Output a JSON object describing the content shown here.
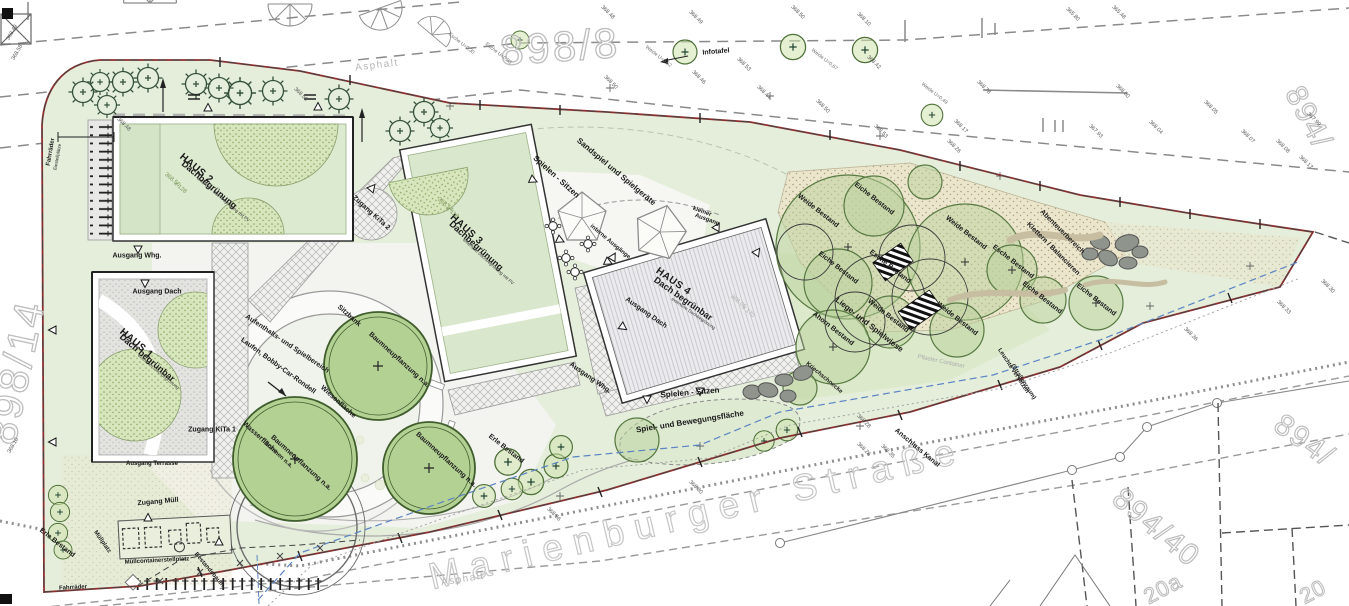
{
  "colors": {
    "site_green": "#e4eeda",
    "boundary_red": "#8c2f2f",
    "roof_green": "#d9e7cc",
    "roof_gray": "#e3e3e1",
    "sand": "#ebe5cc",
    "water_blue": "#5b84c4",
    "tree_green": "#b9d29c"
  },
  "labels": [
    {
      "t": "898/8",
      "x": 560,
      "y": 47,
      "r": -4,
      "k": "p",
      "n": "parcel-898-8"
    },
    {
      "t": "898/14",
      "x": 16,
      "y": 372,
      "r": -78,
      "k": "p",
      "n": "parcel-898-14"
    },
    {
      "t": "894/",
      "x": 1308,
      "y": 118,
      "r": 62,
      "k": "p2",
      "n": "parcel-894"
    },
    {
      "t": "894/",
      "x": 1304,
      "y": 441,
      "r": 36,
      "k": "p2",
      "n": "parcel-894b"
    },
    {
      "t": "894/40",
      "x": 1156,
      "y": 528,
      "r": 40,
      "k": "p2",
      "n": "parcel-894-40"
    },
    {
      "t": "20a",
      "x": 1163,
      "y": 589,
      "r": -28,
      "k": "p3",
      "n": "housenumber-20a"
    },
    {
      "t": "20",
      "x": 1313,
      "y": 592,
      "r": -28,
      "k": "p3",
      "n": "housenumber-20"
    },
    {
      "t": "Marienburger Straße",
      "x": 697,
      "y": 513,
      "r": -13.5,
      "k": "st",
      "n": "street-name"
    },
    {
      "t": "Asphalt",
      "x": 377,
      "y": 66,
      "r": -7,
      "k": "g",
      "n": "surface-asphalt-top"
    },
    {
      "t": "Asphalt",
      "x": 463,
      "y": 580,
      "r": -9,
      "k": "g",
      "n": "surface-asphalt-bottom"
    },
    {
      "t": "HAUS 2",
      "x": 196,
      "y": 169,
      "r": 40,
      "k": "h1",
      "n": "haus-2-title"
    },
    {
      "t": "Dachbegrünung",
      "x": 209,
      "y": 185,
      "r": 40,
      "k": "h2"
    },
    {
      "t": "extensive Dachbegrünung mit PV",
      "x": 223,
      "y": 200,
      "r": 40,
      "k": "h3"
    },
    {
      "t": "HAUS 1",
      "x": 136,
      "y": 344,
      "r": 40,
      "k": "h1",
      "n": "haus-1-title"
    },
    {
      "t": "Dach begrünbar",
      "x": 147,
      "y": 358,
      "r": 40,
      "k": "h2"
    },
    {
      "t": "extensive Dachbegrünung",
      "x": 158,
      "y": 372,
      "r": 40,
      "k": "h3"
    },
    {
      "t": "HAUS 3",
      "x": 466,
      "y": 230,
      "r": 42,
      "k": "h1",
      "n": "haus-3-title"
    },
    {
      "t": "Dachbegrünung",
      "x": 476,
      "y": 246,
      "r": 42,
      "k": "h2"
    },
    {
      "t": "extensive Dachbegrünung mit PV",
      "x": 488,
      "y": 262,
      "r": 42,
      "k": "h3"
    },
    {
      "t": "HAUS 4",
      "x": 673,
      "y": 282,
      "r": 35,
      "k": "h1",
      "n": "haus-4-title"
    },
    {
      "t": "Dach begrünbar",
      "x": 683,
      "y": 299,
      "r": 35,
      "k": "h2"
    },
    {
      "t": "extensive Dachbegrünung",
      "x": 693,
      "y": 314,
      "r": 35,
      "k": "h3"
    },
    {
      "t": "Ausgang Whg.",
      "x": 137,
      "y": 256,
      "r": 0,
      "k": "s"
    },
    {
      "t": "Ausgang Dach",
      "x": 157,
      "y": 292,
      "r": 0,
      "k": "s"
    },
    {
      "t": "Ausgang Dach",
      "x": 646,
      "y": 313,
      "r": 35,
      "k": "s"
    },
    {
      "t": "Ausgang Whg.",
      "x": 590,
      "y": 378,
      "r": 35,
      "k": "s"
    },
    {
      "t": "Zugang KiTa 1",
      "x": 212,
      "y": 430,
      "r": 0,
      "k": "s"
    },
    {
      "t": "Zugang KiTa 2",
      "x": 371,
      "y": 213,
      "r": 42,
      "k": "s"
    },
    {
      "t": "Ausgang Terrasse",
      "x": 152,
      "y": 464,
      "r": 0,
      "k": "s2"
    },
    {
      "t": "Zugang Müll",
      "x": 158,
      "y": 502,
      "r": -5,
      "k": "s"
    },
    {
      "t": "Müllcontainerstellplatz",
      "x": 157,
      "y": 561,
      "r": -3,
      "k": "s2"
    },
    {
      "t": "Müllplatz",
      "x": 102,
      "y": 542,
      "r": 55,
      "k": "s2"
    },
    {
      "t": "Fahrräder",
      "x": 73,
      "y": 588,
      "r": -3,
      "k": "s2"
    },
    {
      "t": "Fahrräder",
      "x": 51,
      "y": 152,
      "r": -80,
      "k": "s2"
    },
    {
      "t": "Einstellplätze",
      "x": 58,
      "y": 157,
      "r": -80,
      "k": "s3"
    },
    {
      "t": "Sitzbank",
      "x": 349,
      "y": 316,
      "r": 42,
      "k": "s"
    },
    {
      "t": "Wiesenfläche",
      "x": 338,
      "y": 402,
      "r": 42,
      "k": "s"
    },
    {
      "t": "Wasserfläche",
      "x": 260,
      "y": 438,
      "r": 42,
      "k": "s"
    },
    {
      "t": "Brunnen n.a.",
      "x": 278,
      "y": 455,
      "r": 42,
      "k": "s2"
    },
    {
      "t": "Baumneupflanzung n.a.",
      "x": 399,
      "y": 360,
      "r": 42,
      "k": "s"
    },
    {
      "t": "Baumneupflanzung n.a.",
      "x": 301,
      "y": 463,
      "r": 42,
      "k": "s"
    },
    {
      "t": "Baumneupflanzung n.a.",
      "x": 446,
      "y": 460,
      "r": 42,
      "k": "s"
    },
    {
      "t": "Aufenthalts- und Spielbereich",
      "x": 287,
      "y": 344,
      "r": 34,
      "k": "s"
    },
    {
      "t": "Laufen, Bobby-Car-Rondell",
      "x": 278,
      "y": 366,
      "r": 36,
      "k": "s"
    },
    {
      "t": "Sandspiel und Spielgeräte",
      "x": 616,
      "y": 172,
      "r": 40,
      "k": "l"
    },
    {
      "t": "Spielen - Sitzen",
      "x": 556,
      "y": 177,
      "r": 42,
      "k": "l"
    },
    {
      "t": "Spielen - Sitzen",
      "x": 690,
      "y": 393,
      "r": -5,
      "k": "l"
    },
    {
      "t": "Spiel- und Bewegungsfläche",
      "x": 690,
      "y": 422,
      "r": -9,
      "k": "l"
    },
    {
      "t": "interne Ausgänge",
      "x": 610,
      "y": 242,
      "r": 40,
      "k": "s2"
    },
    {
      "t": "kleiner",
      "x": 702,
      "y": 212,
      "r": 20,
      "k": "s2"
    },
    {
      "t": "Ausgang",
      "x": 707,
      "y": 220,
      "r": 20,
      "k": "s2"
    },
    {
      "t": "Infotafel",
      "x": 716,
      "y": 52,
      "r": -5,
      "k": "s"
    },
    {
      "t": "Liege- und Spielwiese",
      "x": 869,
      "y": 325,
      "r": 38,
      "k": "l"
    },
    {
      "t": "Ahorn Bestand",
      "x": 833,
      "y": 329,
      "r": 38,
      "k": "s"
    },
    {
      "t": "Weide Bestand",
      "x": 818,
      "y": 211,
      "r": 38,
      "k": "s"
    },
    {
      "t": "Weide Bestand",
      "x": 966,
      "y": 233,
      "r": 38,
      "k": "s"
    },
    {
      "t": "Weide Bestand",
      "x": 888,
      "y": 316,
      "r": 38,
      "k": "s"
    },
    {
      "t": "Weide Bestand",
      "x": 957,
      "y": 319,
      "r": 38,
      "k": "s"
    },
    {
      "t": "Esche Bestand",
      "x": 890,
      "y": 267,
      "r": 38,
      "k": "s"
    },
    {
      "t": "Esche Bestand",
      "x": 1013,
      "y": 262,
      "r": 38,
      "k": "s"
    },
    {
      "t": "Eiche Bestand",
      "x": 874,
      "y": 199,
      "r": 38,
      "k": "s"
    },
    {
      "t": "Eiche Bestand",
      "x": 838,
      "y": 268,
      "r": 38,
      "k": "s"
    },
    {
      "t": "Eiche Bestand",
      "x": 1096,
      "y": 300,
      "r": 38,
      "k": "s"
    },
    {
      "t": "Eiche Bestand",
      "x": 1042,
      "y": 298,
      "r": 38,
      "k": "s"
    },
    {
      "t": "Erle Bestand",
      "x": 506,
      "y": 449,
      "r": 38,
      "k": "s"
    },
    {
      "t": "Erle Bestand",
      "x": 57,
      "y": 543,
      "r": 38,
      "k": "s"
    },
    {
      "t": "Abenteuerbereich",
      "x": 1062,
      "y": 232,
      "r": 45,
      "k": "s"
    },
    {
      "t": "Klettern / Balancieren",
      "x": 1053,
      "y": 249,
      "r": 45,
      "k": "s"
    },
    {
      "t": "Anschluss Kanal",
      "x": 917,
      "y": 448,
      "r": 40,
      "k": "s"
    },
    {
      "t": "Leuchte versetzen",
      "x": 1013,
      "y": 371,
      "r": 57,
      "k": "s2"
    },
    {
      "t": "(Straßenraum)",
      "x": 1023,
      "y": 382,
      "r": 57,
      "k": "s2"
    },
    {
      "t": "Kriechschnecke",
      "x": 824,
      "y": 378,
      "r": 40,
      "k": "s2"
    },
    {
      "t": "Pflaster Container",
      "x": 941,
      "y": 362,
      "r": 12,
      "k": "g2"
    },
    {
      "t": "Bestandsbaum",
      "x": 209,
      "y": 570,
      "r": 50,
      "k": "s2"
    },
    {
      "t": "Esche U=0,30",
      "x": 461,
      "y": 44,
      "r": 38,
      "k": "tg"
    },
    {
      "t": "Esche U=0,33",
      "x": 498,
      "y": 54,
      "r": 38,
      "k": "tg"
    },
    {
      "t": "Weide U=0,52",
      "x": 658,
      "y": 57,
      "r": 38,
      "k": "tg"
    },
    {
      "t": "Weide U=0,67",
      "x": 824,
      "y": 60,
      "r": 38,
      "k": "tg"
    },
    {
      "t": "Weide U=0,49",
      "x": 934,
      "y": 94,
      "r": 38,
      "k": "tg"
    },
    {
      "t": "368.48",
      "x": 607,
      "y": 13,
      "r": 45,
      "k": "e"
    },
    {
      "t": "368.49",
      "x": 695,
      "y": 18,
      "r": 45,
      "k": "e"
    },
    {
      "t": "368.50",
      "x": 797,
      "y": 13,
      "r": 45,
      "k": "e"
    },
    {
      "t": "368.10",
      "x": 863,
      "y": 20,
      "r": 45,
      "k": "e"
    },
    {
      "t": "368.50",
      "x": 610,
      "y": 83,
      "r": 45,
      "k": "e"
    },
    {
      "t": "368.53",
      "x": 743,
      "y": 65,
      "r": 45,
      "k": "e"
    },
    {
      "t": "368.46",
      "x": 698,
      "y": 78,
      "r": 45,
      "k": "e"
    },
    {
      "t": "368.44",
      "x": 763,
      "y": 93,
      "r": 45,
      "k": "e"
    },
    {
      "t": "368.50",
      "x": 822,
      "y": 107,
      "r": 45,
      "k": "e"
    },
    {
      "t": "368.53",
      "x": 880,
      "y": 132,
      "r": 45,
      "k": "e"
    },
    {
      "t": "368.42",
      "x": 873,
      "y": 63,
      "r": 45,
      "k": "e"
    },
    {
      "t": "365.80",
      "x": 1072,
      "y": 15,
      "r": 45,
      "k": "e"
    },
    {
      "t": "365.48",
      "x": 1118,
      "y": 13,
      "r": 45,
      "k": "e"
    },
    {
      "t": "368.78",
      "x": 983,
      "y": 88,
      "r": 45,
      "k": "e"
    },
    {
      "t": "368.80",
      "x": 1122,
      "y": 92,
      "r": 45,
      "k": "e"
    },
    {
      "t": "368.05",
      "x": 1210,
      "y": 108,
      "r": 45,
      "k": "e"
    },
    {
      "t": "367.99",
      "x": 1313,
      "y": 120,
      "r": 45,
      "k": "e"
    },
    {
      "t": "368.17",
      "x": 960,
      "y": 127,
      "r": 45,
      "k": "e"
    },
    {
      "t": "367.93",
      "x": 1095,
      "y": 132,
      "r": 45,
      "k": "e"
    },
    {
      "t": "368.04",
      "x": 1155,
      "y": 128,
      "r": 45,
      "k": "e"
    },
    {
      "t": "368.07",
      "x": 1247,
      "y": 137,
      "r": 45,
      "k": "e"
    },
    {
      "t": "368.08",
      "x": 1282,
      "y": 147,
      "r": 45,
      "k": "e"
    },
    {
      "t": "368.17",
      "x": 1305,
      "y": 163,
      "r": 45,
      "k": "e"
    },
    {
      "t": "368.26",
      "x": 953,
      "y": 147,
      "r": 45,
      "k": "e"
    },
    {
      "t": "368.26",
      "x": 863,
      "y": 450,
      "r": 45,
      "k": "e"
    },
    {
      "t": "368.30",
      "x": 695,
      "y": 488,
      "r": 45,
      "k": "e"
    },
    {
      "t": "368.56",
      "x": 553,
      "y": 515,
      "r": 45,
      "k": "e"
    },
    {
      "t": "368.35",
      "x": 887,
      "y": 452,
      "r": 45,
      "k": "e"
    },
    {
      "t": "368.28",
      "x": 863,
      "y": 422,
      "r": 45,
      "k": "e"
    },
    {
      "t": "368.36",
      "x": 1190,
      "y": 335,
      "r": 45,
      "k": "e"
    },
    {
      "t": "368.33",
      "x": 1283,
      "y": 308,
      "r": 45,
      "k": "e"
    },
    {
      "t": "368.30",
      "x": 1327,
      "y": 287,
      "r": 45,
      "k": "e"
    },
    {
      "t": "368.58",
      "x": 18,
      "y": 53,
      "r": -60,
      "k": "e"
    },
    {
      "t": "368.49",
      "x": 13,
      "y": 33,
      "r": -60,
      "k": "e"
    },
    {
      "t": "368.48",
      "x": 123,
      "y": 125,
      "r": 45,
      "k": "e"
    },
    {
      "t": "368.10",
      "x": 14,
      "y": 446,
      "r": -60,
      "k": "e"
    },
    {
      "t": "368.50",
      "x": 300,
      "y": 95,
      "r": 45,
      "k": "e"
    },
    {
      "t": "368.54",
      "x": 445,
      "y": 205,
      "r": 40,
      "k": "egr"
    },
    {
      "t": "x 118",
      "x": 452,
      "y": 213,
      "r": 40,
      "k": "egr"
    },
    {
      "t": "368.56",
      "x": 172,
      "y": 180,
      "r": 40,
      "k": "egr"
    },
    {
      "t": "x 128",
      "x": 180,
      "y": 188,
      "r": 40,
      "k": "egr"
    },
    {
      "t": "368.05",
      "x": 738,
      "y": 302,
      "r": 40,
      "k": "eg"
    },
    {
      "t": "x 170",
      "x": 748,
      "y": 312,
      "r": 40,
      "k": "eg"
    }
  ]
}
